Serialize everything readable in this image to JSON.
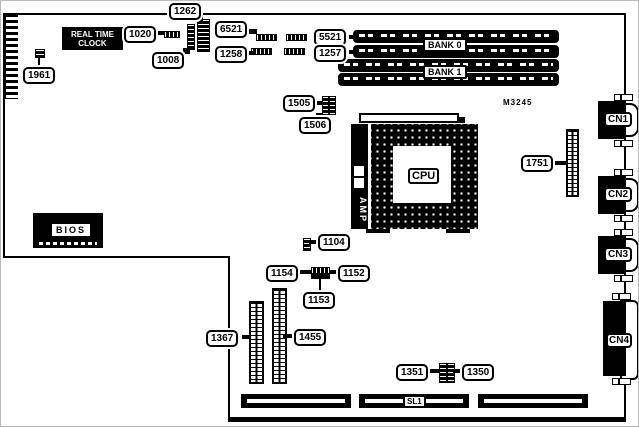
{
  "board": {
    "model": "M3245",
    "rtc_line1": "REAL TIME",
    "rtc_line2": "CLOCK",
    "bios": "BIOS",
    "cpu": "CPU",
    "amp": "AMP",
    "bank0": "BANK 0",
    "bank1": "BANK 1",
    "sl1": "SL1",
    "cn1": "CN1",
    "cn2": "CN2",
    "cn3": "CN3",
    "cn4": "CN4"
  },
  "callouts": {
    "c1961": "1961",
    "c1020": "1020",
    "c1262": "1262",
    "c1008": "1008",
    "c6521": "6521",
    "c1258": "1258",
    "c5521": "5521",
    "c1257": "1257",
    "c1505": "1505",
    "c1506": "1506",
    "c1751": "1751",
    "c1104": "1104",
    "c1154": "1154",
    "c1152": "1152",
    "c1153": "1153",
    "c1367": "1367",
    "c1455": "1455",
    "c1351": "1351",
    "c1350": "1350"
  },
  "colors": {
    "ink": "#000000",
    "paper": "#ffffff"
  }
}
